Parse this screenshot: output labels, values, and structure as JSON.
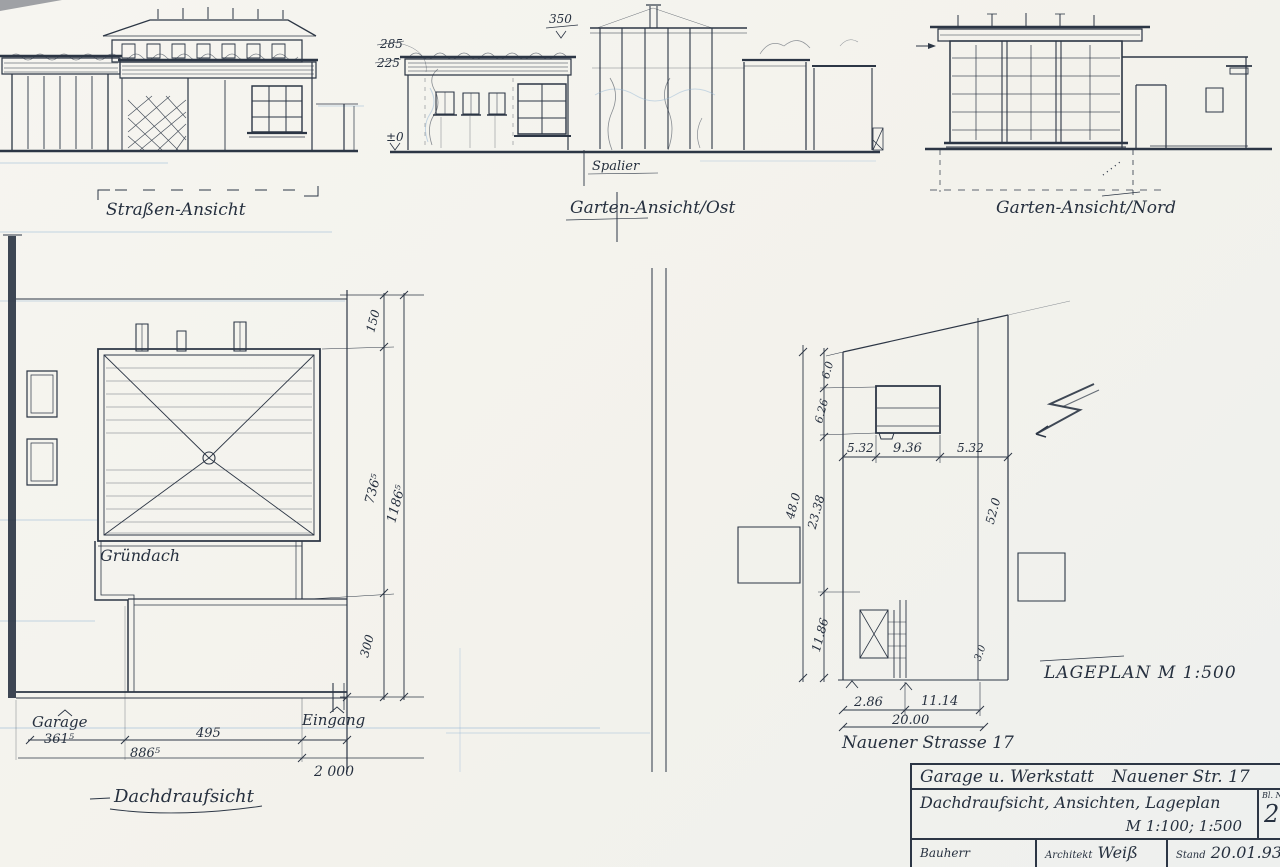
{
  "labels": {
    "street_elevation": "Straßen-Ansicht",
    "garden_east_elevation": "Garten-Ansicht/Ost",
    "garden_north_elevation": "Garten-Ansicht/Nord",
    "spalier": "Spalier",
    "green_roof": "Gründach",
    "garage": "Garage",
    "entrance": "Eingang",
    "roof_plan_title": "Dachdraufsicht",
    "site_plan_title": "LAGEPLAN  M 1:500",
    "street_name": "Nauener Strasse 17"
  },
  "elevation_dims": {
    "ridge_height": "350",
    "eave_height": "285",
    "ceiling_height": "225",
    "ground_level": "±0"
  },
  "roof_plan_dims": {
    "offset_top": "150",
    "roof_depth": "736⁵",
    "path_width": "300",
    "total_depth": "1186⁵",
    "garage_width": "361⁵",
    "mid_width": "886⁵",
    "upper_width": "495",
    "total_width": "2 000"
  },
  "site_plan_dims": {
    "left_top": "6.0",
    "left_upper": "6.26",
    "left_mid": "23.38",
    "left_lower": "11.86",
    "left_total": "48.0",
    "front_left": "5.32",
    "front_mid": "9.36",
    "front_right": "5.32",
    "right_total": "52.0",
    "right_small": "3.0",
    "bottom_left": "2.86",
    "bottom_right": "11.14",
    "bottom_total": "20.00"
  },
  "title_block": {
    "project": "Garage u. Werkstatt",
    "address": "Nauener Str. 17",
    "sheet_title": "Dachdraufsicht, Ansichten, Lageplan",
    "scale": "M 1:100; 1:500",
    "sheet_no_label": "Bl. N",
    "sheet_no": "2",
    "client_label": "Bauherr",
    "architect_label": "Architekt",
    "architect_name": "Weiß",
    "status_label": "Stand",
    "status_date": "20.01.93"
  }
}
